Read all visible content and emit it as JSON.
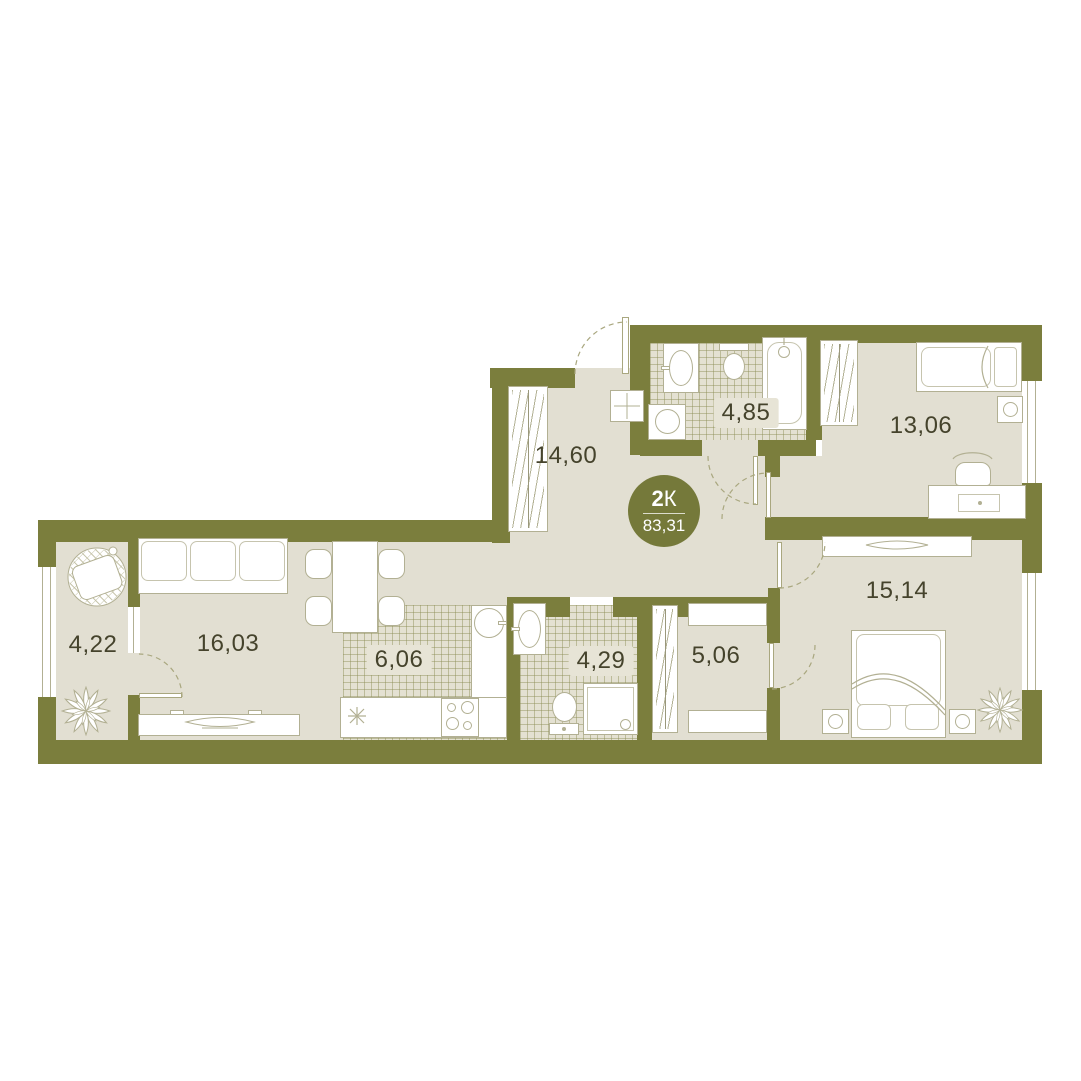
{
  "plan": {
    "type_label_bold": "2",
    "type_label_suffix": "К",
    "total_area": "83,31"
  },
  "rooms": [
    {
      "key": "hallway",
      "area": "14,60"
    },
    {
      "key": "bathroom-main",
      "area": "4,85"
    },
    {
      "key": "bedroom-top",
      "area": "13,06"
    },
    {
      "key": "balcony",
      "area": "4,22"
    },
    {
      "key": "living-room",
      "area": "16,03"
    },
    {
      "key": "kitchen",
      "area": "6,06"
    },
    {
      "key": "bathroom-small",
      "area": "4,29"
    },
    {
      "key": "closet-hall",
      "area": "5,06"
    },
    {
      "key": "bedroom-bottom",
      "area": "15,14"
    }
  ],
  "colors": {
    "wall": "#7b7e3d",
    "floor": "#e2dfd2",
    "outline": "#b2b093",
    "text": "#45432c",
    "badge": "#75793a"
  }
}
